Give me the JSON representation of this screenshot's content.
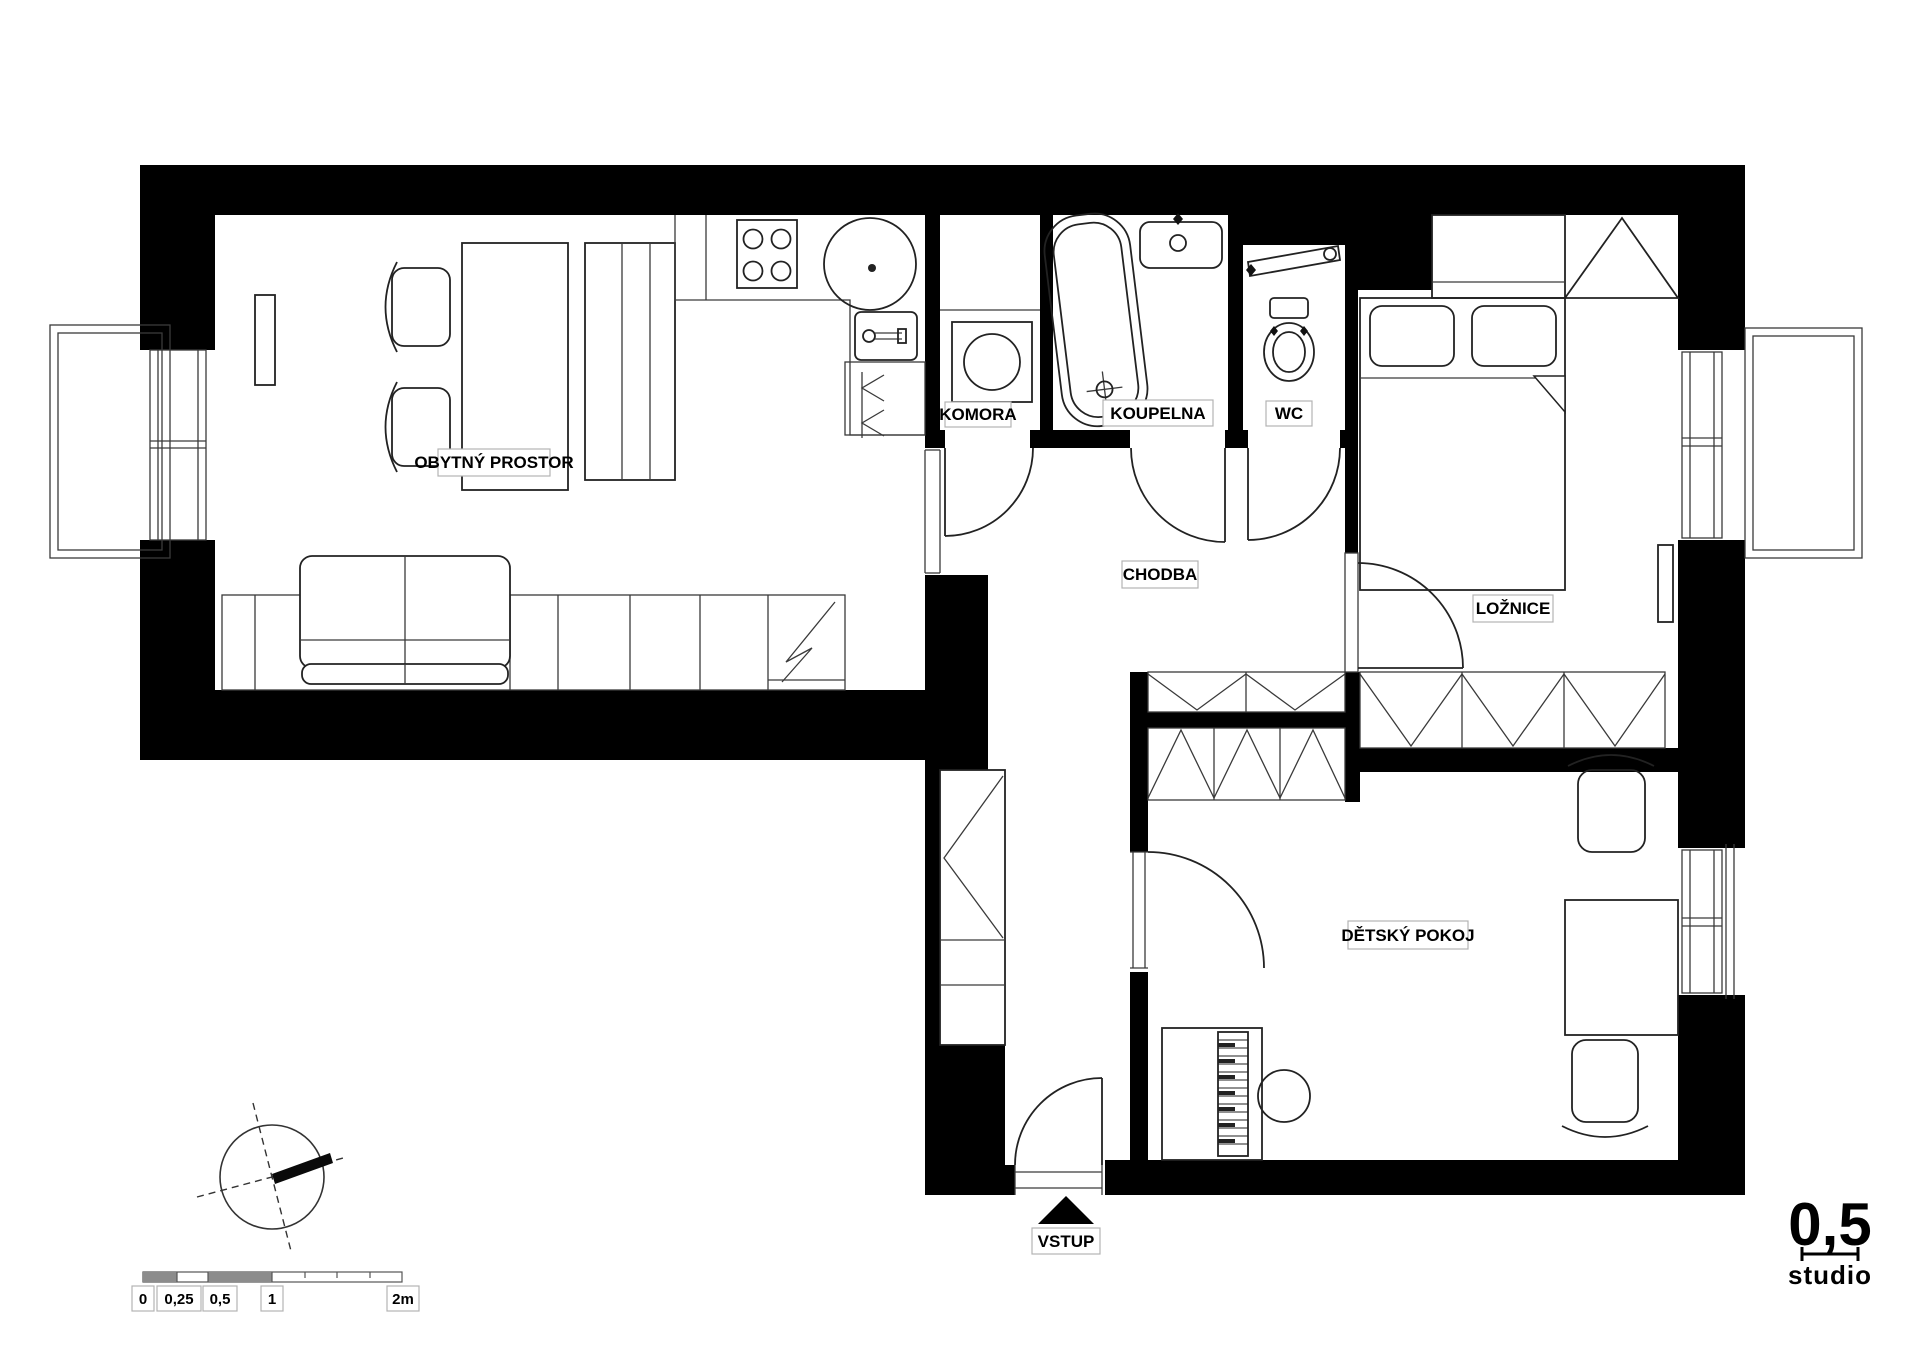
{
  "plan": {
    "rooms": {
      "living": "OBYTNÝ PROSTOR",
      "pantry": "KOMORA",
      "bathroom": "KOUPELNA",
      "wc": "WC",
      "hallway": "CHODBA",
      "bedroom": "LOŽNICE",
      "kids_room": "DĚTSKÝ POKOJ"
    },
    "entrance_label": "VSTUP"
  },
  "scale_bar": {
    "t0": "0",
    "t025": "0,25",
    "t05": "0,5",
    "t1": "1",
    "t2": "2m"
  },
  "logo": {
    "number": "0,5",
    "name": "studio"
  },
  "colors": {
    "wall": "#000000",
    "line": "#2a2a2a",
    "label_border": "#b3b3b3",
    "scale_fill": "#8c8c8c"
  }
}
